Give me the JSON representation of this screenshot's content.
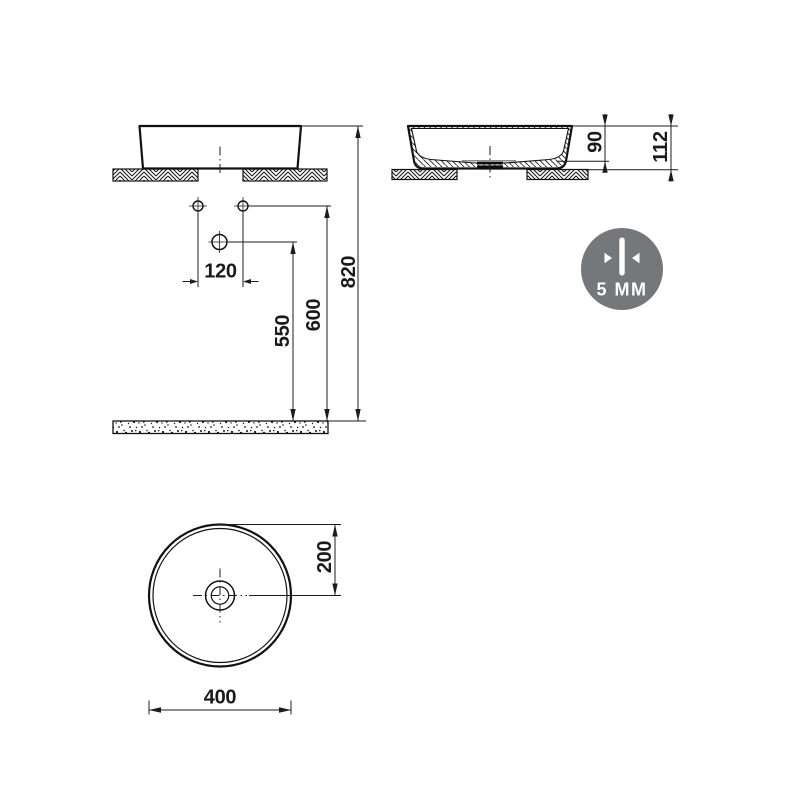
{
  "front_view": {
    "hole_spacing_mm": "120",
    "drain_height_mm": "550",
    "supply_height_mm": "600",
    "rim_height_mm": "820"
  },
  "side_view": {
    "basin_depth_mm": "90",
    "basin_total_height_mm": "112"
  },
  "top_view": {
    "drain_center_offset_mm": "200",
    "basin_diameter_mm": "400"
  },
  "badge": {
    "label": "5 MM",
    "background_color": "#75787b",
    "icon": "wall-thickness-arrows-icon"
  },
  "colors": {
    "line": "#1a1a1a",
    "background": "#ffffff"
  }
}
